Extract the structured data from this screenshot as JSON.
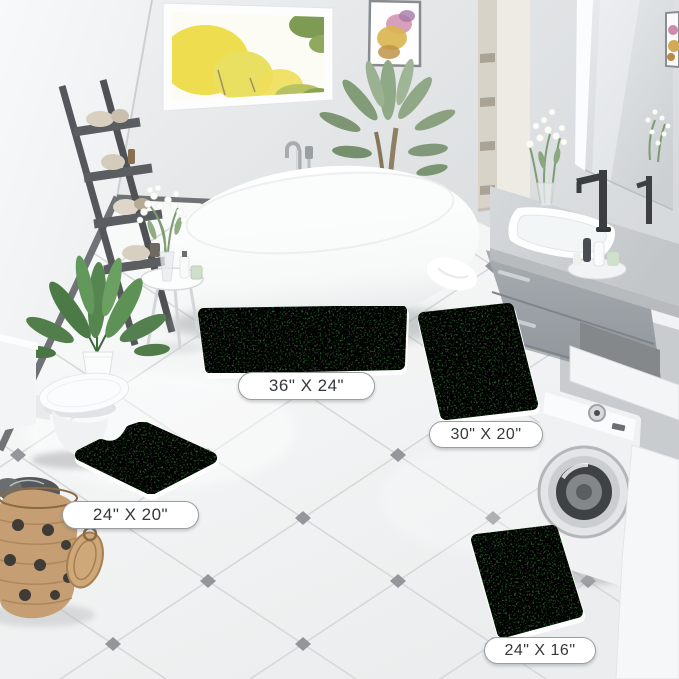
{
  "rugs": [
    {
      "id": "rug-36x24",
      "label": "36\" X 24\""
    },
    {
      "id": "rug-30x20",
      "label": "30\" X 20\""
    },
    {
      "id": "rug-24x20-contour",
      "label": "24\" X 20\""
    },
    {
      "id": "rug-24x16",
      "label": "24\" X 16\""
    }
  ],
  "colors": {
    "rug_green": "#4e8b52",
    "rug_green_dark": "#3f7a44",
    "floor_white": "#f6f7f7",
    "tile_grout": "#d4d7d8",
    "accent_diamond": "#8e9294",
    "wall_gray": "#dfe2e4",
    "left_wall": "#f6f7f8",
    "vanity_gray": "#9aa0a5",
    "ladder_gray": "#565a5d",
    "tree_yellow": "#eedd4e",
    "plant_green": "#568650",
    "basket_tan": "#c59f73",
    "label_bg": "#ffffff",
    "label_border": "#999ea1",
    "label_text": "#36393c"
  }
}
